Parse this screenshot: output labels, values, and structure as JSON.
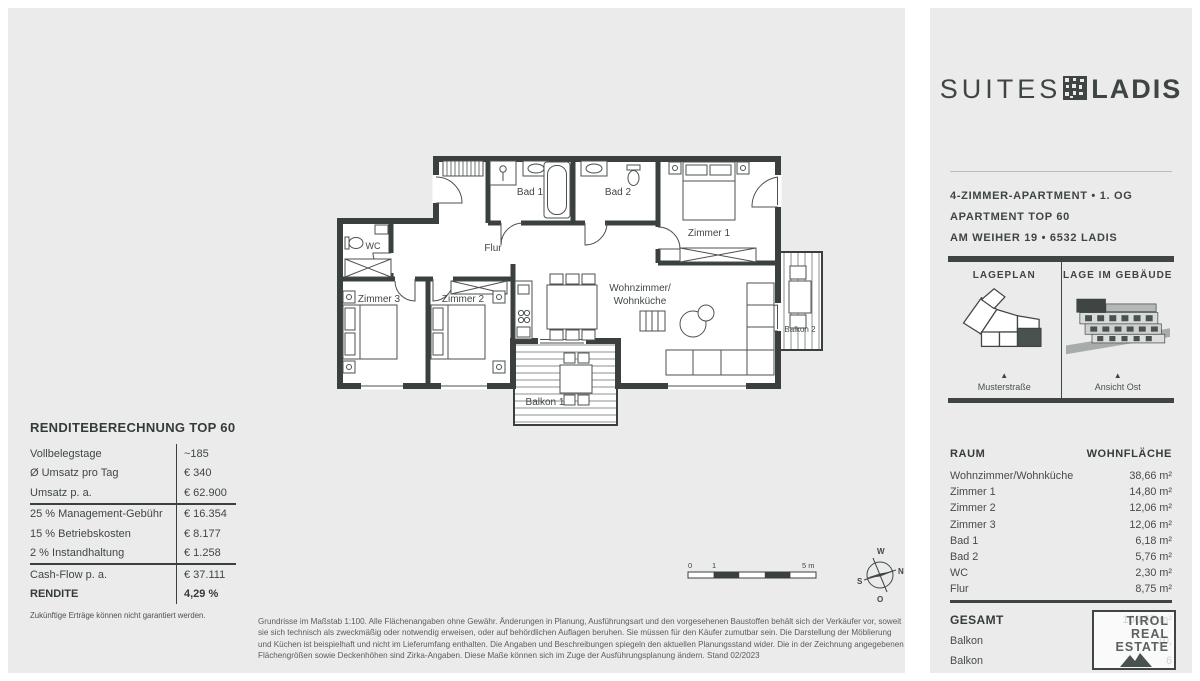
{
  "colors": {
    "accent_dark": "#3e4542",
    "panel_bg": "#ebebeb"
  },
  "icons": {
    "triangle_marker": "▲"
  },
  "right_panel": {
    "brand": {
      "suites": "SUITES",
      "ladis": "LADIS"
    },
    "info_lines": [
      "4-ZIMMER-APARTMENT • 1. OG",
      "APARTMENT TOP 60",
      "AM WEIHER 19 • 6532 LADIS"
    ],
    "location": {
      "lageplan_title": "LAGEPLAN",
      "lageplan_caption": "Musterstraße",
      "gebaeude_title": "LAGE IM GEBÄUDE",
      "gebaeude_caption": "Ansicht Ost"
    },
    "rooms": {
      "header": {
        "raum": "RAUM",
        "flaeche": "WOHNFLÄCHE"
      },
      "rows": [
        {
          "name": "Wohnzimmer/Wohnküche",
          "area": "38,66 m²"
        },
        {
          "name": "Zimmer 1",
          "area": "14,80 m²"
        },
        {
          "name": "Zimmer 2",
          "area": "12,06 m²"
        },
        {
          "name": "Zimmer 3",
          "area": "12,06 m²"
        },
        {
          "name": "Bad 1",
          "area": "6,18 m²"
        },
        {
          "name": "Bad 2",
          "area": "5,76 m²"
        },
        {
          "name": "WC",
          "area": "2,30 m²"
        },
        {
          "name": "Flur",
          "area": "8,75 m²"
        }
      ],
      "total_label": "GESAMT",
      "total_area": "100,57 m²",
      "extra": [
        {
          "name": "Balkon",
          "area": "10,"
        },
        {
          "name": "Balkon",
          "area": "6"
        }
      ]
    },
    "watermark": [
      "TIROL",
      "REAL",
      "ESTATE"
    ]
  },
  "rendite": {
    "title": "RENDITEBERECHNUNG TOP 60",
    "rows": [
      {
        "label": "Vollbelegstage",
        "value": "~185"
      },
      {
        "label": "Ø Umsatz pro Tag",
        "value": "€ 340"
      },
      {
        "label": "Umsatz p. a.",
        "value": "€ 62.900"
      },
      {
        "label": "25 % Management-Gebühr",
        "value": "€ 16.354"
      },
      {
        "label": "15 % Betriebskosten",
        "value": "€ 8.177"
      },
      {
        "label": "2 % Instandhaltung",
        "value": "€ 1.258"
      },
      {
        "label": "Cash-Flow p. a.",
        "value": "€ 37.111"
      },
      {
        "label": "RENDITE",
        "value": "4,29 %"
      }
    ],
    "footnote": "Zukünftige Erträge können nicht garantiert werden."
  },
  "floorplan": {
    "labels": {
      "flur": "Flur",
      "wc": "WC",
      "bad1": "Bad 1",
      "bad2": "Bad 2",
      "zimmer1": "Zimmer 1",
      "zimmer2": "Zimmer 2",
      "zimmer3": "Zimmer 3",
      "wohnzimmer_line1": "Wohnzimmer/",
      "wohnzimmer_line2": "Wohnküche",
      "balkon1": "Balkon 1",
      "balkon2": "Balkon 2"
    },
    "scalebar": {
      "start": "0",
      "mid": "1",
      "end": "5 m"
    },
    "compass": {
      "n": "N",
      "s": "S",
      "w": "W",
      "o": "O"
    }
  },
  "disclaimer": "Grundrisse im Maßstab 1:100. Alle Flächenangaben ohne Gewähr. Änderungen in Planung, Ausführungsart und den vorgesehenen Baustoffen behält sich der Verkäufer vor, soweit sie sich technisch als zweckmäßig oder notwendig erweisen, oder auf behördlichen Auflagen beruhen. Sie müssen für den Käufer zumutbar sein. Die Darstellung der Möblierung und Küchen ist beispielhaft und nicht im Lieferumfang enthalten. Die Angaben und Beschreibungen spiegeln den aktuellen Planungsstand wider. Die in der Zeichnung angegebenen Flächengrößen sowie Deckenhöhen sind Zirka-Angaben. Diese Maße können sich im Zuge der Ausführungsplanung ändern. Stand 02/2023"
}
